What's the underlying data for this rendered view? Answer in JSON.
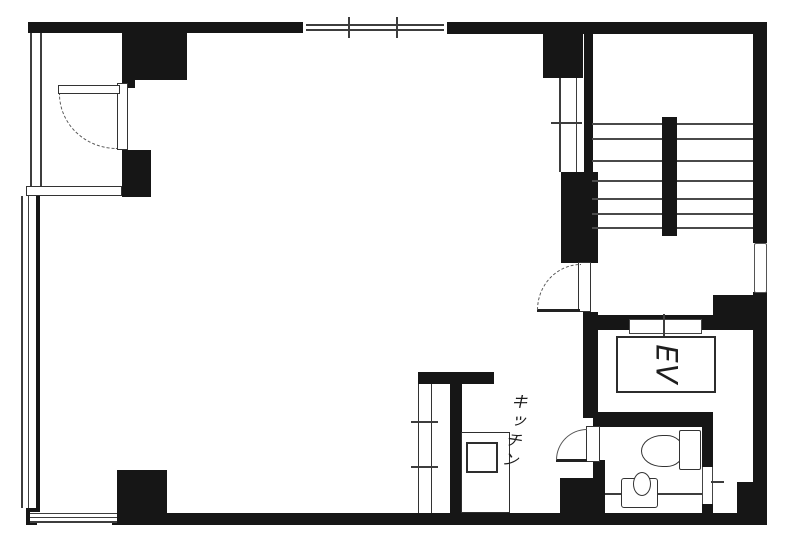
{
  "floorplan": {
    "labels": {
      "kitchen": "キッチン",
      "elevator": "EV"
    },
    "colors": {
      "walls": "#161616",
      "lines": "#3d3d3d",
      "background": "#ffffff"
    }
  }
}
